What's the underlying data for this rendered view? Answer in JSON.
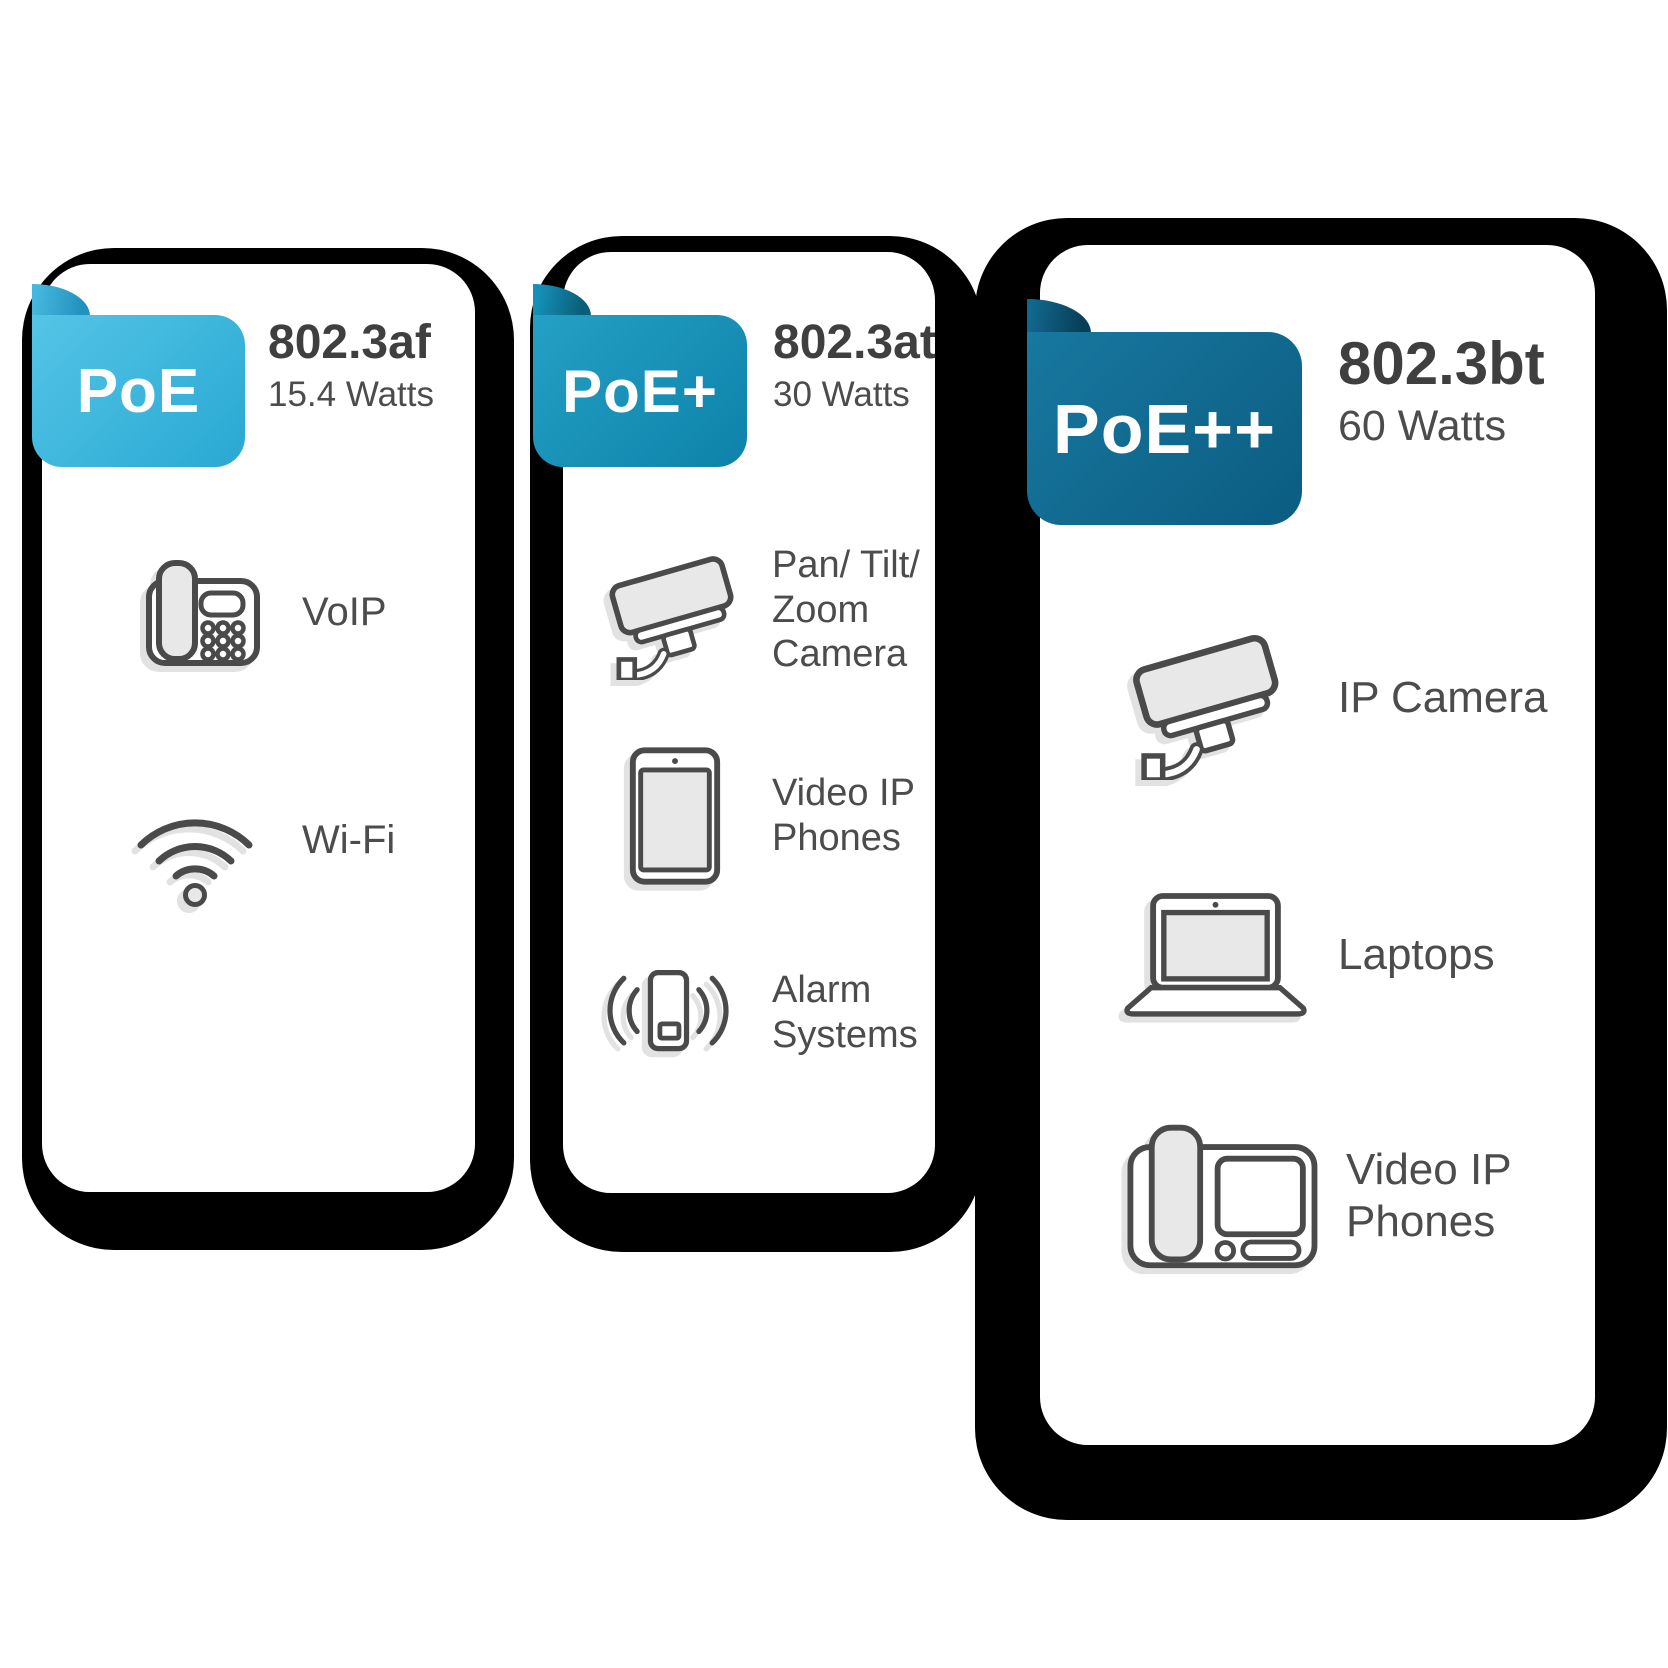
{
  "theme": {
    "poe-a": "#54c5e6",
    "poe-b": "#29a8d3",
    "poe-fold-a": "#45b8dd",
    "poe-fold-b": "#2391bd",
    "poe-plus-a": "#25a0c5",
    "poe-plus-b": "#0d82aa",
    "poe-plus-fold-a": "#1690b8",
    "poe-plus-fold-b": "#0a5e78",
    "poe-pp-a": "#1878a0",
    "poe-pp-b": "#0b5c81",
    "poe-pp-fold-a": "#11678d",
    "poe-pp-fold-b": "#083f58",
    "ink": "#3f3f3f",
    "muted": "#4c4c4c",
    "icon-stroke": "#4a4a4a",
    "icon-fill": "#e8e8e8",
    "shadow": "#000000",
    "card-bg": "#ffffff"
  },
  "cards": [
    {
      "ribbon": "PoE",
      "standard": "802.3af",
      "watts": "15.4 Watts",
      "devices": [
        {
          "icon": "desk-phone-icon",
          "label": "VoIP"
        },
        {
          "icon": "wifi-icon",
          "label": "Wi-Fi"
        }
      ]
    },
    {
      "ribbon": "PoE+",
      "standard": "802.3at",
      "watts": "30 Watts",
      "devices": [
        {
          "icon": "cctv-camera-icon",
          "label": "Pan/ Tilt/\nZoom\nCamera"
        },
        {
          "icon": "tablet-icon",
          "label": "Video IP\nPhones"
        },
        {
          "icon": "alarm-icon",
          "label": "Alarm\nSystems"
        }
      ]
    },
    {
      "ribbon": "PoE++",
      "standard": "802.3bt",
      "watts": "60 Watts",
      "devices": [
        {
          "icon": "cctv-camera-icon",
          "label": "IP Camera"
        },
        {
          "icon": "laptop-icon",
          "label": "Laptops"
        },
        {
          "icon": "video-ip-phone-icon",
          "label": "Video IP\nPhones"
        }
      ]
    }
  ]
}
